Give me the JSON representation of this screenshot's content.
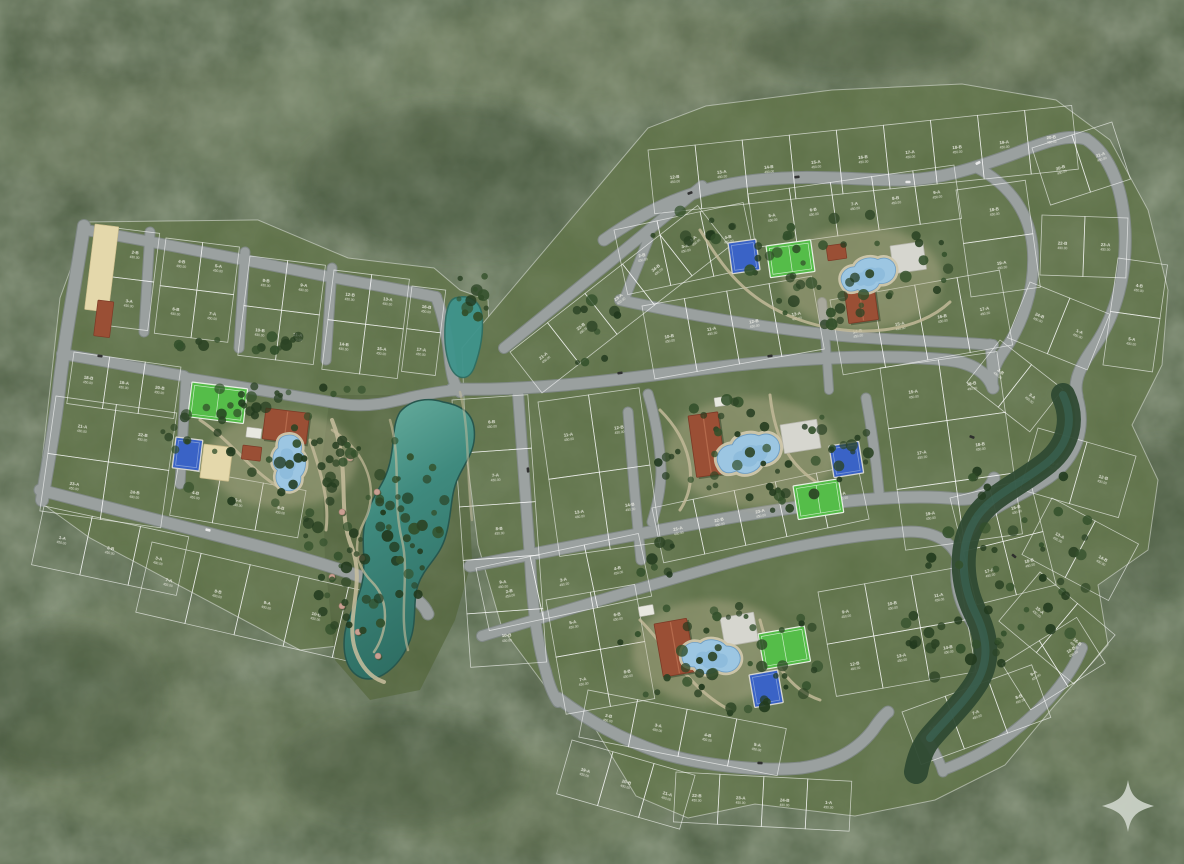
{
  "scene": {
    "title": "residential-master-plan-aerial-render",
    "watermark_icon": "sparkle-star-icon",
    "legibility_note": "lot labels are illegible tiny white two-line text in source"
  },
  "palette": {
    "forest_base": "#4a5a40",
    "forest_light": "#7d8a6b",
    "forest_dark": "#2d3f28",
    "plat_green": "#5e7148",
    "plat_green_alt": "#596c44",
    "garden_green": "#556740",
    "lot_border": "rgba(255,255,255,0.62)",
    "road_gray": "#9aa09f",
    "road_edge": "#82898a",
    "path_tan": "#c8be9d",
    "plaza_tan": "#c2b897",
    "water_light": "#79b9ab",
    "water_deep": "#2e6e63",
    "pond_teal": "#3f948c",
    "creek_dark": "#2f4a33",
    "creek_teal": "#3c6a5c",
    "pool_water": "#9cc6e2",
    "pool_deep": "#7fb2d6",
    "pool_deck": "#cfc7ac",
    "roof_terracotta": "#9a4f35",
    "roof_ridge": "#b56a4c",
    "field_green": "#55bd49",
    "court_blue": "#3a63c6",
    "court_blue_line": "#7f9bd8",
    "court_white": "#d6d6cf",
    "sand": "#e4d8ab",
    "tree_dark": "#223a1e",
    "tree_mid": "#2c4425",
    "tree_lite": "#33502b",
    "label_white": "#f2f2ea",
    "watermark": "#cdd4c9",
    "car_dark": "#2b2b2b",
    "car_white": "#ececec"
  },
  "lot_label": {
    "line2": "450.00",
    "suffixes": [
      "A",
      "B"
    ],
    "legibility": "illegible-in-source"
  },
  "blocks": [
    [
      116,
      228,
      44,
      98,
      7,
      1,
      2
    ],
    [
      166,
      238,
      74,
      96,
      7,
      2,
      2
    ],
    [
      250,
      256,
      76,
      100,
      7,
      2,
      2
    ],
    [
      334,
      270,
      76,
      100,
      7,
      2,
      2
    ],
    [
      412,
      286,
      34,
      86,
      7,
      1,
      2
    ],
    [
      74,
      352,
      108,
      52,
      8,
      3,
      1
    ],
    [
      56,
      396,
      122,
      116,
      8,
      2,
      2
    ],
    [
      44,
      506,
      148,
      60,
      12,
      3,
      1
    ],
    [
      178,
      468,
      130,
      48,
      10,
      3,
      1
    ],
    [
      152,
      542,
      252,
      72,
      13,
      5,
      1
    ],
    [
      648,
      150,
      426,
      64,
      -6,
      9,
      1
    ],
    [
      510,
      352,
      238,
      52,
      -38,
      5,
      1
    ],
    [
      614,
      230,
      132,
      66,
      -12,
      3,
      1
    ],
    [
      748,
      194,
      208,
      54,
      -8,
      5,
      1
    ],
    [
      642,
      306,
      172,
      74,
      -10,
      4,
      1
    ],
    [
      830,
      300,
      172,
      76,
      -10,
      4,
      1
    ],
    [
      956,
      190,
      70,
      108,
      -8,
      1,
      2
    ],
    [
      1032,
      148,
      84,
      60,
      -18,
      2,
      1
    ],
    [
      1042,
      215,
      86,
      60,
      2,
      2,
      1
    ],
    [
      1030,
      282,
      86,
      60,
      22,
      2,
      1
    ],
    [
      1000,
      340,
      80,
      54,
      38,
      2,
      1
    ],
    [
      1118,
      258,
      50,
      108,
      8,
      1,
      2
    ],
    [
      452,
      400,
      76,
      268,
      -4,
      1,
      5
    ],
    [
      538,
      402,
      102,
      156,
      -8,
      2,
      2
    ],
    [
      880,
      368,
      118,
      184,
      -8,
      2,
      3
    ],
    [
      652,
      508,
      210,
      56,
      -12,
      5,
      1
    ],
    [
      476,
      568,
      166,
      64,
      -12,
      3,
      1
    ],
    [
      546,
      600,
      90,
      116,
      -10,
      2,
      2
    ],
    [
      818,
      592,
      142,
      106,
      -10,
      3,
      2
    ],
    [
      950,
      498,
      82,
      110,
      -14,
      2,
      2
    ],
    [
      572,
      740,
      128,
      56,
      16,
      3,
      1
    ],
    [
      676,
      772,
      176,
      50,
      3,
      4,
      1
    ],
    [
      588,
      690,
      202,
      48,
      11,
      4,
      1
    ],
    [
      902,
      712,
      138,
      56,
      -20,
      3,
      1
    ],
    [
      1002,
      664,
      88,
      54,
      -32,
      2,
      1
    ],
    [
      1038,
      428,
      102,
      64,
      16,
      2,
      1
    ],
    [
      1052,
      498,
      98,
      64,
      28,
      2,
      1
    ],
    [
      1040,
      572,
      98,
      64,
      40,
      2,
      1
    ]
  ],
  "roads": [
    {
      "d": "M84,226 C76,280 66,330 60,380 C55,428 48,462 42,500",
      "w": 12
    },
    {
      "d": "M86,230 C160,243 240,259 330,277 C368,284 404,290 436,297",
      "w": 10
    },
    {
      "d": "M150,232 L144,332",
      "w": 9
    },
    {
      "d": "M245,252 L239,348",
      "w": 9
    },
    {
      "d": "M332,268 L326,360",
      "w": 9
    },
    {
      "d": "M62,354 C110,362 150,370 184,376",
      "w": 10
    },
    {
      "d": "M186,378 C184,412 182,448 180,484",
      "w": 9
    },
    {
      "d": "M40,490 C110,508 180,526 258,546 C312,560 356,574 398,590 C414,596 424,604 428,614",
      "w": 11
    },
    {
      "d": "M436,297 C444,318 448,340 450,362 C452,376 454,386 460,392",
      "w": 10
    },
    {
      "d": "M186,378 C250,388 305,398 342,404 C368,408 392,402 412,397 C432,393 448,390 462,390",
      "w": 10
    },
    {
      "d": "M604,240 C652,206 692,190 742,182 C802,173 852,180 900,180 C940,180 974,168 1008,156 C1038,145 1064,133 1086,139",
      "w": 11
    },
    {
      "d": "M504,348 L610,262 L702,186",
      "w": 10
    },
    {
      "d": "M1086,139 C1112,156 1123,192 1125,230 C1127,274 1116,314 1096,344 C1081,365 1073,380 1077,396",
      "w": 11
    },
    {
      "d": "M976,167 C1012,186 1031,216 1033,252 C1035,292 1021,326 1006,348 C996,362 990,375 993,388",
      "w": 10
    },
    {
      "d": "M648,240 C640,260 632,280 624,300",
      "w": 9
    },
    {
      "d": "M620,300 C692,316 762,327 832,335 C892,341 946,341 993,345",
      "w": 10
    },
    {
      "d": "M990,344 C992,358 992,372 993,388",
      "w": 9
    },
    {
      "d": "M452,389 C540,391 622,379 702,369 C782,359 880,353 948,360 C974,363 988,374 993,388",
      "w": 11
    },
    {
      "d": "M518,394 C522,450 526,504 530,558 C532,600 536,640 546,672",
      "w": 10
    },
    {
      "d": "M470,566 C560,549 650,531 740,516 C830,501 908,493 958,499 C978,501 990,490 994,478",
      "w": 11
    },
    {
      "d": "M482,636 C560,612 640,588 718,566 C788,546 848,536 902,532 C936,529 956,544 960,565",
      "w": 10
    },
    {
      "d": "M1077,396 C1087,428 1077,458 1049,478 C1016,500 986,508 969,532 C951,558 953,592 969,618 C983,640 987,662 973,684 C959,704 941,722 926,738",
      "w": 10
    },
    {
      "d": "M866,398 C872,430 876,460 879,492",
      "w": 9
    },
    {
      "d": "M648,394 C656,420 660,446 661,470 C661,490 657,506 652,522",
      "w": 9
    },
    {
      "d": "M628,412 C632,462 636,512 641,560",
      "w": 9
    },
    {
      "d": "M558,698 C590,722 621,739 661,753 C701,765 761,772 801,768 C831,764 856,752 873,730 C879,721 884,715 888,712",
      "w": 11
    },
    {
      "d": "M943,770 C988,753 1020,730 1048,700 C1064,682 1076,664 1082,648",
      "w": 10
    },
    {
      "d": "M822,302 C825,330 827,360 829,390",
      "w": 8
    },
    {
      "d": "M546,672 C550,688 554,696 558,702",
      "w": 10
    },
    {
      "d": "M926,738 C934,750 940,762 943,772",
      "w": 9
    }
  ],
  "walk_paths": [
    {
      "d": "M332,420 C352,470 336,510 352,548 C366,584 344,620 356,652 C362,668 372,678 384,682",
      "w": 4,
      "o": 0.85
    },
    {
      "d": "M332,430 C368,452 380,492 364,522 C352,545 356,566 372,582 C390,600 388,632 374,652",
      "w": 2.5,
      "o": 0.7
    },
    {
      "d": "M390,420 C402,460 392,500 402,540 C410,575 398,615 408,650",
      "w": 2.5,
      "o": 0.6
    },
    {
      "d": "M700,230 C720,262 742,300 800,320 C858,340 918,332 950,302",
      "w": 3,
      "o": 0.8
    },
    {
      "d": "M660,410 C690,440 700,480 680,510 M770,395 C775,440 790,470 830,490",
      "w": 3,
      "o": 0.8
    },
    {
      "d": "M640,620 C670,650 690,690 730,710 M760,620 C770,660 790,690 820,700",
      "w": 3,
      "o": 0.8
    },
    {
      "d": "M200,420 C230,440 250,470 280,488 M310,440 C320,470 330,500 326,530",
      "w": 3,
      "o": 0.8
    },
    {
      "d": "M460,392 C470,430 466,470 472,520",
      "w": 2.5,
      "o": 0.5
    }
  ],
  "tree_clusters": [
    [
      240,
      344,
      100,
      10,
      14
    ],
    [
      285,
      392,
      85,
      9,
      12
    ],
    [
      250,
      452,
      95,
      55,
      42
    ],
    [
      360,
      540,
      55,
      115,
      58
    ],
    [
      470,
      305,
      26,
      38,
      12
    ],
    [
      850,
      268,
      108,
      58,
      48
    ],
    [
      768,
      455,
      112,
      62,
      52
    ],
    [
      722,
      656,
      108,
      58,
      46
    ],
    [
      1008,
      560,
      85,
      115,
      46
    ],
    [
      700,
      228,
      55,
      18,
      10
    ],
    [
      408,
      520,
      38,
      85,
      22
    ],
    [
      596,
      332,
      26,
      44,
      10
    ],
    [
      930,
      640,
      40,
      40,
      12
    ],
    [
      660,
      560,
      40,
      20,
      8
    ]
  ],
  "garden_features": [
    [
      350,
      458
    ],
    [
      377,
      492
    ],
    [
      342,
      512
    ],
    [
      362,
      558
    ],
    [
      332,
      577
    ],
    [
      342,
      606
    ],
    [
      358,
      632
    ],
    [
      378,
      656
    ]
  ],
  "cars": [
    [
      690,
      193,
      -20,
      "dark"
    ],
    [
      797,
      177,
      -5,
      "dark"
    ],
    [
      908,
      182,
      0,
      "white"
    ],
    [
      978,
      163,
      -25,
      "white"
    ],
    [
      620,
      373,
      -8,
      "dark"
    ],
    [
      770,
      356,
      -8,
      "dark"
    ],
    [
      528,
      470,
      85,
      "dark"
    ],
    [
      972,
      437,
      20,
      "dark"
    ],
    [
      1014,
      556,
      40,
      "dark"
    ],
    [
      100,
      356,
      5,
      "dark"
    ],
    [
      208,
      530,
      13,
      "white"
    ],
    [
      760,
      763,
      2,
      "dark"
    ]
  ],
  "amenities": {
    "north": {
      "plaza": [
        862,
        278,
        80,
        52
      ],
      "pool": [
        868,
        276,
        1.0,
        -8
      ],
      "clubhouse": [
        843,
        282,
        30,
        42,
        -8
      ],
      "outbuilding": [
        826,
        246,
        19,
        15,
        -8
      ],
      "field": [
        766,
        246,
        45,
        32,
        -8
      ],
      "court_blue": [
        728,
        243,
        28,
        31,
        -8
      ],
      "court_white": [
        890,
        246,
        33,
        28,
        -8
      ]
    },
    "central": {
      "plaza": [
        752,
        452,
        85,
        55
      ],
      "pool": [
        748,
        455,
        1.15,
        -9
      ],
      "clubhouse": [
        688,
        416,
        30,
        62,
        -8
      ],
      "outbuilding_white": [
        714,
        398,
        15,
        9,
        -8
      ],
      "court_white": [
        780,
        425,
        37,
        29,
        -9
      ],
      "court_blue": [
        829,
        446,
        30,
        32,
        -9
      ],
      "field": [
        793,
        486,
        46,
        34,
        -9
      ]
    },
    "south": {
      "plaza": [
        712,
        652,
        80,
        52
      ],
      "pool": [
        710,
        658,
        1.05,
        15
      ],
      "clubhouse": [
        654,
        624,
        33,
        54,
        -10
      ],
      "outbuilding_white": [
        638,
        607,
        15,
        10,
        -10
      ],
      "court_white": [
        720,
        618,
        34,
        29,
        -10
      ],
      "field": [
        758,
        634,
        47,
        36,
        -10
      ],
      "court_blue": [
        749,
        675,
        29,
        33,
        -10
      ]
    },
    "west": {
      "plaza": [
        282,
        460,
        75,
        48
      ],
      "pool": [
        288,
        462,
        1.0,
        100
      ],
      "clubhouse": [
        266,
        408,
        44,
        31,
        7
      ],
      "outbuilding": [
        243,
        445,
        19,
        14,
        7
      ],
      "outbuilding_white": [
        247,
        427,
        15,
        10,
        7
      ],
      "field": [
        192,
        382,
        56,
        35,
        7
      ],
      "court_blue": [
        176,
        437,
        27,
        31,
        7
      ],
      "sand_court": [
        204,
        444,
        29,
        34,
        7
      ]
    },
    "beach": {
      "sand_strip": [
        95,
        224,
        24,
        86,
        7
      ],
      "gate_building": [
        98,
        300,
        16,
        36,
        7
      ]
    }
  }
}
